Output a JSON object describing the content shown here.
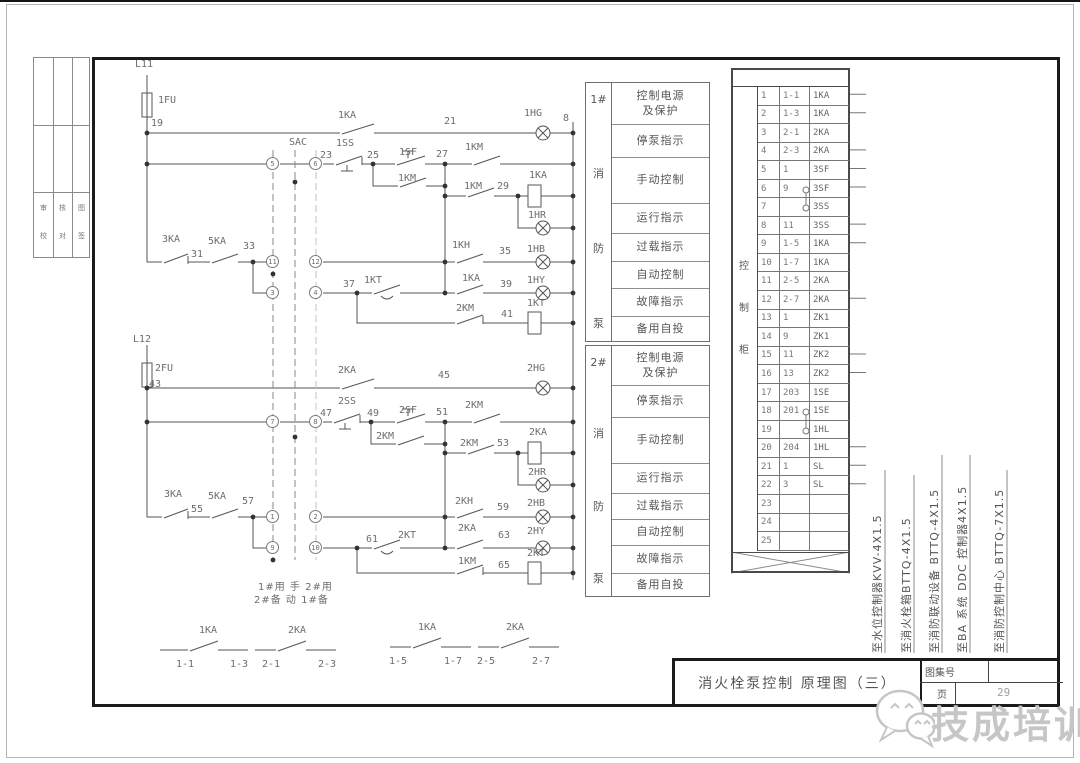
{
  "page": {
    "bg": "#ffffff",
    "line_color": "#555555",
    "label_color": "#6d6d6d",
    "frame_color": "#1b1b1b",
    "watermark_color": "#c6c6c6"
  },
  "title_block": {
    "title": "消火栓泵控制  原理图（三）",
    "atlas_label": "图集号",
    "atlas_value": "",
    "page_label": "页",
    "page_value": "29"
  },
  "watermark": {
    "text": "技成培训",
    "logo": "wechat-bubbles-icon"
  },
  "left_strip": {
    "cells_row1": [
      "审",
      "核",
      "图"
    ],
    "cells_row2": [
      "校",
      "对",
      "签"
    ]
  },
  "mode_note": {
    "line1": "1#用 手 2#用",
    "line2": "2#备 动 1#备"
  },
  "panels": [
    {
      "pump": "1#",
      "unit": [
        "消",
        "防",
        "泵"
      ],
      "rows": [
        "控制电源\n及保护",
        "停泵指示",
        "手动控制",
        "运行指示",
        "过载指示",
        "自动控制",
        "故障指示",
        "备用自投"
      ]
    },
    {
      "pump": "2#",
      "unit": [
        "消",
        "防",
        "泵"
      ],
      "rows": [
        "控制电源\n及保护",
        "停泵指示",
        "手动控制",
        "运行指示",
        "过载指示",
        "自动控制",
        "故障指示",
        "备用自投"
      ]
    }
  ],
  "terminal": {
    "cabinet": [
      "控",
      "制",
      "柜"
    ],
    "rows": [
      {
        "no": "1",
        "wire": "1-1",
        "dev": "1KA"
      },
      {
        "no": "2",
        "wire": "1-3",
        "dev": "1KA"
      },
      {
        "no": "3",
        "wire": "2-1",
        "dev": "2KA"
      },
      {
        "no": "4",
        "wire": "2-3",
        "dev": "2KA"
      },
      {
        "no": "5",
        "wire": "1",
        "dev": "3SF"
      },
      {
        "no": "6",
        "wire": "9",
        "dev": "3SF"
      },
      {
        "no": "7",
        "wire": "",
        "dev": "3SS"
      },
      {
        "no": "8",
        "wire": "11",
        "dev": "3SS"
      },
      {
        "no": "9",
        "wire": "1-5",
        "dev": "1KA"
      },
      {
        "no": "10",
        "wire": "1-7",
        "dev": "1KA"
      },
      {
        "no": "11",
        "wire": "2-5",
        "dev": "2KA"
      },
      {
        "no": "12",
        "wire": "2-7",
        "dev": "2KA"
      },
      {
        "no": "13",
        "wire": "1",
        "dev": "ZK1"
      },
      {
        "no": "14",
        "wire": "9",
        "dev": "ZK1"
      },
      {
        "no": "15",
        "wire": "11",
        "dev": "ZK2"
      },
      {
        "no": "16",
        "wire": "13",
        "dev": "ZK2"
      },
      {
        "no": "17",
        "wire": "203",
        "dev": "1SE"
      },
      {
        "no": "18",
        "wire": "201",
        "dev": "1SE"
      },
      {
        "no": "19",
        "wire": "",
        "dev": "1HL"
      },
      {
        "no": "20",
        "wire": "204",
        "dev": "1HL"
      },
      {
        "no": "21",
        "wire": "1",
        "dev": "SL"
      },
      {
        "no": "22",
        "wire": "3",
        "dev": "SL"
      },
      {
        "no": "23",
        "wire": "",
        "dev": ""
      },
      {
        "no": "24",
        "wire": "",
        "dev": ""
      },
      {
        "no": "25",
        "wire": "",
        "dev": ""
      }
    ]
  },
  "cables": [
    {
      "text": "至水位控制器KVV-4X1.5"
    },
    {
      "text": "至消火栓箱BTTQ-4X1.5"
    },
    {
      "text": "至消防联动设备 BTTQ-4X1.5"
    },
    {
      "text": "至BA 系统 DDC 控制器4X1.5"
    },
    {
      "text": "至消防控制中心 BTTQ-7X1.5"
    }
  ],
  "schematic": {
    "labels": [
      {
        "x": 135,
        "y": 60,
        "t": "L11"
      },
      {
        "x": 158,
        "y": 96,
        "t": "1FU"
      },
      {
        "x": 151,
        "y": 119,
        "t": "19"
      },
      {
        "x": 338,
        "y": 111,
        "t": "1KA"
      },
      {
        "x": 444,
        "y": 117,
        "t": "21"
      },
      {
        "x": 524,
        "y": 109,
        "t": "1HG"
      },
      {
        "x": 563,
        "y": 114,
        "t": "8"
      },
      {
        "x": 289,
        "y": 138,
        "t": "SAC"
      },
      {
        "x": 320,
        "y": 151,
        "t": "23"
      },
      {
        "x": 336,
        "y": 139,
        "t": "1SS"
      },
      {
        "x": 367,
        "y": 151,
        "t": "25"
      },
      {
        "x": 399,
        "y": 148,
        "t": "1SF"
      },
      {
        "x": 436,
        "y": 150,
        "t": "27"
      },
      {
        "x": 465,
        "y": 143,
        "t": "1KM"
      },
      {
        "x": 398,
        "y": 174,
        "t": "1KM"
      },
      {
        "x": 464,
        "y": 182,
        "t": "1KM"
      },
      {
        "x": 497,
        "y": 182,
        "t": "29"
      },
      {
        "x": 529,
        "y": 171,
        "t": "1KA"
      },
      {
        "x": 528,
        "y": 211,
        "t": "1HR"
      },
      {
        "x": 452,
        "y": 241,
        "t": "1KH"
      },
      {
        "x": 499,
        "y": 247,
        "t": "35"
      },
      {
        "x": 527,
        "y": 245,
        "t": "1HB"
      },
      {
        "x": 162,
        "y": 235,
        "t": "3KA"
      },
      {
        "x": 191,
        "y": 250,
        "t": "31"
      },
      {
        "x": 208,
        "y": 237,
        "t": "5KA"
      },
      {
        "x": 243,
        "y": 242,
        "t": "33"
      },
      {
        "x": 343,
        "y": 280,
        "t": "37"
      },
      {
        "x": 364,
        "y": 276,
        "t": "1KT"
      },
      {
        "x": 462,
        "y": 274,
        "t": "1KA"
      },
      {
        "x": 500,
        "y": 280,
        "t": "39"
      },
      {
        "x": 527,
        "y": 276,
        "t": "1HY"
      },
      {
        "x": 456,
        "y": 304,
        "t": "2KM"
      },
      {
        "x": 501,
        "y": 310,
        "t": "41"
      },
      {
        "x": 527,
        "y": 299,
        "t": "1KT"
      },
      {
        "x": 133,
        "y": 335,
        "t": "L12"
      },
      {
        "x": 155,
        "y": 364,
        "t": "2FU"
      },
      {
        "x": 149,
        "y": 380,
        "t": "43"
      },
      {
        "x": 338,
        "y": 366,
        "t": "2KA"
      },
      {
        "x": 438,
        "y": 371,
        "t": "45"
      },
      {
        "x": 527,
        "y": 364,
        "t": "2HG"
      },
      {
        "x": 320,
        "y": 409,
        "t": "47"
      },
      {
        "x": 338,
        "y": 397,
        "t": "2SS"
      },
      {
        "x": 367,
        "y": 409,
        "t": "49"
      },
      {
        "x": 399,
        "y": 406,
        "t": "2SF"
      },
      {
        "x": 436,
        "y": 408,
        "t": "51"
      },
      {
        "x": 465,
        "y": 401,
        "t": "2KM"
      },
      {
        "x": 376,
        "y": 432,
        "t": "2KM"
      },
      {
        "x": 460,
        "y": 439,
        "t": "2KM"
      },
      {
        "x": 497,
        "y": 439,
        "t": "53"
      },
      {
        "x": 529,
        "y": 428,
        "t": "2KA"
      },
      {
        "x": 528,
        "y": 468,
        "t": "2HR"
      },
      {
        "x": 455,
        "y": 497,
        "t": "2KH"
      },
      {
        "x": 497,
        "y": 503,
        "t": "59"
      },
      {
        "x": 527,
        "y": 499,
        "t": "2HB"
      },
      {
        "x": 164,
        "y": 490,
        "t": "3KA"
      },
      {
        "x": 191,
        "y": 505,
        "t": "55"
      },
      {
        "x": 208,
        "y": 492,
        "t": "5KA"
      },
      {
        "x": 242,
        "y": 497,
        "t": "57"
      },
      {
        "x": 366,
        "y": 535,
        "t": "61"
      },
      {
        "x": 398,
        "y": 531,
        "t": "2KT"
      },
      {
        "x": 458,
        "y": 524,
        "t": "2KA"
      },
      {
        "x": 498,
        "y": 531,
        "t": "63"
      },
      {
        "x": 527,
        "y": 527,
        "t": "2HY"
      },
      {
        "x": 458,
        "y": 557,
        "t": "1KM"
      },
      {
        "x": 498,
        "y": 561,
        "t": "65"
      },
      {
        "x": 527,
        "y": 549,
        "t": "2KT"
      },
      {
        "x": 199,
        "y": 626,
        "t": "1KA"
      },
      {
        "x": 176,
        "y": 660,
        "t": "1-1"
      },
      {
        "x": 230,
        "y": 660,
        "t": "1-3"
      },
      {
        "x": 288,
        "y": 626,
        "t": "2KA"
      },
      {
        "x": 262,
        "y": 660,
        "t": "2-1"
      },
      {
        "x": 318,
        "y": 660,
        "t": "2-3"
      },
      {
        "x": 418,
        "y": 623,
        "t": "1KA"
      },
      {
        "x": 389,
        "y": 657,
        "t": "1-5"
      },
      {
        "x": 444,
        "y": 657,
        "t": "1-7"
      },
      {
        "x": 506,
        "y": 623,
        "t": "2KA"
      },
      {
        "x": 477,
        "y": 657,
        "t": "2-5"
      },
      {
        "x": 532,
        "y": 657,
        "t": "2-7"
      }
    ],
    "circled": [
      {
        "x": 273,
        "y": 164,
        "t": "5"
      },
      {
        "x": 316,
        "y": 164,
        "t": "6"
      },
      {
        "x": 273,
        "y": 262,
        "t": "11"
      },
      {
        "x": 316,
        "y": 262,
        "t": "12"
      },
      {
        "x": 273,
        "y": 293,
        "t": "3"
      },
      {
        "x": 316,
        "y": 293,
        "t": "4"
      },
      {
        "x": 273,
        "y": 422,
        "t": "7"
      },
      {
        "x": 316,
        "y": 422,
        "t": "8"
      },
      {
        "x": 273,
        "y": 517,
        "t": "1"
      },
      {
        "x": 316,
        "y": 517,
        "t": "2"
      },
      {
        "x": 273,
        "y": 548,
        "t": "9"
      },
      {
        "x": 316,
        "y": 548,
        "t": "10"
      }
    ]
  }
}
